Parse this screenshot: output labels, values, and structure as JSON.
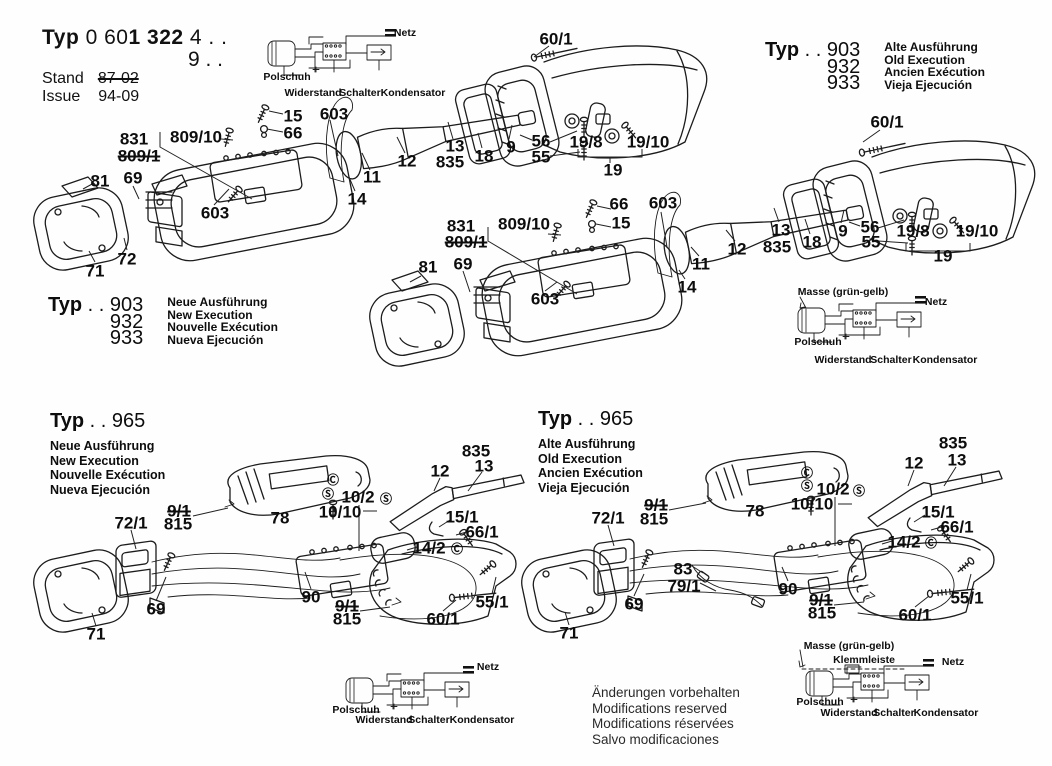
{
  "title": {
    "typ": "Typ",
    "num_a": " 0 60",
    "num_b": "1 322",
    "suffix1": " 4 . .",
    "suffix2": "9 . .",
    "stand_label": "Stand",
    "stand_value": "87-02",
    "issue_label": "Issue",
    "issue_value": "94-09"
  },
  "typ_blocks": [
    {
      "typ": "Typ",
      "dots": ". .",
      "numbers": [
        "903",
        "932",
        "933"
      ],
      "variants": [
        "Alte Ausführung",
        "Old Execution",
        "Ancien Exécution",
        "Vieja Ejecución"
      ]
    },
    {
      "typ": "Typ",
      "dots": ". .",
      "numbers": [
        "903",
        "932",
        "933"
      ],
      "variants": [
        "Neue Ausführung",
        "New Execution",
        "Nouvelle Exécution",
        "Nueva Ejecución"
      ]
    },
    {
      "typ": "Typ",
      "dots": ". .",
      "numbers": [
        "965"
      ],
      "variants": [
        "Neue Ausführung",
        "New Execution",
        "Nouvelle Exécution",
        "Nueva Ejecución"
      ]
    },
    {
      "typ": "Typ",
      "dots": ". .",
      "numbers": [
        "965"
      ],
      "variants": [
        "Alte Ausführung",
        "Old Execution",
        "Ancien Exécution",
        "Vieja Ejecución"
      ]
    }
  ],
  "footer": {
    "lines": [
      "Änderungen vorbehalten",
      "Modifications reserved",
      "Modifications réservées",
      "Salvo modificaciones"
    ]
  },
  "callouts": [
    {
      "t": "60/1",
      "x": 556,
      "y": 39
    },
    {
      "t": "831",
      "x": 134,
      "y": 139
    },
    {
      "t": "809/1",
      "x": 139,
      "y": 156,
      "strike": 1
    },
    {
      "t": "809/10",
      "x": 196,
      "y": 137
    },
    {
      "t": "15",
      "x": 293,
      "y": 116
    },
    {
      "t": "66",
      "x": 293,
      "y": 133
    },
    {
      "t": "603",
      "x": 334,
      "y": 114
    },
    {
      "t": "81",
      "x": 100,
      "y": 181
    },
    {
      "t": "69",
      "x": 133,
      "y": 178
    },
    {
      "t": "603",
      "x": 215,
      "y": 213
    },
    {
      "t": "71",
      "x": 95,
      "y": 271
    },
    {
      "t": "72",
      "x": 127,
      "y": 259
    },
    {
      "t": "12",
      "x": 407,
      "y": 161
    },
    {
      "t": "11",
      "x": 372,
      "y": 177
    },
    {
      "t": "14",
      "x": 357,
      "y": 199
    },
    {
      "t": "13",
      "x": 455,
      "y": 146
    },
    {
      "t": "835",
      "x": 450,
      "y": 162
    },
    {
      "t": "18",
      "x": 484,
      "y": 156
    },
    {
      "t": "9",
      "x": 511,
      "y": 147
    },
    {
      "t": "56",
      "x": 541,
      "y": 141
    },
    {
      "t": "55",
      "x": 541,
      "y": 157
    },
    {
      "t": "19/8",
      "x": 586,
      "y": 142
    },
    {
      "t": "19/10",
      "x": 648,
      "y": 142
    },
    {
      "t": "19",
      "x": 613,
      "y": 170
    },
    {
      "t": "831",
      "x": 461,
      "y": 226
    },
    {
      "t": "809/1",
      "x": 466,
      "y": 242,
      "strike": 1
    },
    {
      "t": "809/10",
      "x": 524,
      "y": 224
    },
    {
      "t": "66",
      "x": 619,
      "y": 204
    },
    {
      "t": "15",
      "x": 621,
      "y": 223
    },
    {
      "t": "603",
      "x": 663,
      "y": 203
    },
    {
      "t": "603",
      "x": 545,
      "y": 299
    },
    {
      "t": "81",
      "x": 428,
      "y": 267
    },
    {
      "t": "69",
      "x": 463,
      "y": 264
    },
    {
      "t": "12",
      "x": 737,
      "y": 249
    },
    {
      "t": "11",
      "x": 701,
      "y": 264
    },
    {
      "t": "14",
      "x": 687,
      "y": 287
    },
    {
      "t": "13",
      "x": 781,
      "y": 230
    },
    {
      "t": "835",
      "x": 777,
      "y": 247
    },
    {
      "t": "18",
      "x": 812,
      "y": 242
    },
    {
      "t": "9",
      "x": 843,
      "y": 231
    },
    {
      "t": "56",
      "x": 870,
      "y": 227
    },
    {
      "t": "55",
      "x": 871,
      "y": 242
    },
    {
      "t": "19/8",
      "x": 913,
      "y": 231
    },
    {
      "t": "19/10",
      "x": 977,
      "y": 231
    },
    {
      "t": "19",
      "x": 943,
      "y": 256
    },
    {
      "t": "60/1",
      "x": 887,
      "y": 122
    },
    {
      "t": "835",
      "x": 476,
      "y": 451
    },
    {
      "t": "13",
      "x": 484,
      "y": 466
    },
    {
      "t": "12",
      "x": 440,
      "y": 471
    },
    {
      "t": "Ⓒ",
      "x": 333,
      "y": 480,
      "fs": 12
    },
    {
      "t": "Ⓢ",
      "x": 328,
      "y": 494,
      "fs": 12
    },
    {
      "t": "10/2",
      "x": 358,
      "y": 497
    },
    {
      "t": "Ⓢ",
      "x": 386,
      "y": 499,
      "fs": 12
    },
    {
      "t": "10/10",
      "x": 340,
      "y": 512
    },
    {
      "t": "78",
      "x": 280,
      "y": 518
    },
    {
      "t": "15/1",
      "x": 462,
      "y": 517
    },
    {
      "t": "66/1",
      "x": 482,
      "y": 532
    },
    {
      "t": "14/2",
      "x": 429,
      "y": 548
    },
    {
      "t": "Ⓒ",
      "x": 457,
      "y": 549,
      "fs": 12
    },
    {
      "t": "72/1",
      "x": 131,
      "y": 523
    },
    {
      "t": "9/1",
      "x": 179,
      "y": 511,
      "strike": 1
    },
    {
      "t": "815",
      "x": 178,
      "y": 524
    },
    {
      "t": "69",
      "x": 156,
      "y": 609
    },
    {
      "t": "90",
      "x": 311,
      "y": 597
    },
    {
      "t": "9/1",
      "x": 347,
      "y": 606,
      "strike": 1
    },
    {
      "t": "815",
      "x": 347,
      "y": 619
    },
    {
      "t": "60/1",
      "x": 443,
      "y": 619
    },
    {
      "t": "55/1",
      "x": 492,
      "y": 602
    },
    {
      "t": "71",
      "x": 96,
      "y": 634
    },
    {
      "t": "835",
      "x": 953,
      "y": 443
    },
    {
      "t": "13",
      "x": 957,
      "y": 460
    },
    {
      "t": "12",
      "x": 914,
      "y": 463
    },
    {
      "t": "Ⓒ",
      "x": 807,
      "y": 473,
      "fs": 12
    },
    {
      "t": "Ⓢ",
      "x": 807,
      "y": 486,
      "fs": 12
    },
    {
      "t": "10/2",
      "x": 833,
      "y": 489
    },
    {
      "t": "Ⓢ",
      "x": 859,
      "y": 491,
      "fs": 12
    },
    {
      "t": "10/10",
      "x": 812,
      "y": 504
    },
    {
      "t": "78",
      "x": 755,
      "y": 511
    },
    {
      "t": "15/1",
      "x": 938,
      "y": 512
    },
    {
      "t": "66/1",
      "x": 957,
      "y": 527
    },
    {
      "t": "14/2",
      "x": 904,
      "y": 542
    },
    {
      "t": "Ⓒ",
      "x": 931,
      "y": 543,
      "fs": 12
    },
    {
      "t": "72/1",
      "x": 608,
      "y": 518
    },
    {
      "t": "9/1",
      "x": 656,
      "y": 505,
      "strike": 1
    },
    {
      "t": "815",
      "x": 654,
      "y": 519
    },
    {
      "t": "83",
      "x": 683,
      "y": 569
    },
    {
      "t": "79/1",
      "x": 684,
      "y": 586
    },
    {
      "t": "69",
      "x": 634,
      "y": 604
    },
    {
      "t": "90",
      "x": 788,
      "y": 589
    },
    {
      "t": "9/1",
      "x": 821,
      "y": 600,
      "strike": 1
    },
    {
      "t": "815",
      "x": 822,
      "y": 613
    },
    {
      "t": "60/1",
      "x": 915,
      "y": 615
    },
    {
      "t": "55/1",
      "x": 967,
      "y": 598
    },
    {
      "t": "71",
      "x": 569,
      "y": 633
    }
  ],
  "wiring_diagrams": [
    {
      "id": "top",
      "labels": [
        {
          "t": "Netz",
          "x": 405,
          "y": 33
        },
        {
          "t": "Polschuh",
          "x": 287,
          "y": 77
        },
        {
          "t": "Widerstand",
          "x": 313,
          "y": 93
        },
        {
          "t": "Schalter",
          "x": 360,
          "y": 93
        },
        {
          "t": "Kondensator",
          "x": 413,
          "y": 93
        }
      ]
    },
    {
      "id": "right-middle",
      "labels": [
        {
          "t": "Masse (grün-gelb)",
          "x": 843,
          "y": 292
        },
        {
          "t": "Netz",
          "x": 936,
          "y": 302
        },
        {
          "t": "Polschuh",
          "x": 818,
          "y": 342
        },
        {
          "t": "Widerstand",
          "x": 843,
          "y": 360
        },
        {
          "t": "Schalter",
          "x": 891,
          "y": 360
        },
        {
          "t": "Kondensator",
          "x": 945,
          "y": 360
        }
      ]
    },
    {
      "id": "bottom-left",
      "labels": [
        {
          "t": "Netz",
          "x": 488,
          "y": 667
        },
        {
          "t": "Polschuh",
          "x": 356,
          "y": 710
        },
        {
          "t": "Widerstand",
          "x": 384,
          "y": 720
        },
        {
          "t": "Schalter",
          "x": 429,
          "y": 720
        },
        {
          "t": "Kondensator",
          "x": 482,
          "y": 720
        }
      ]
    },
    {
      "id": "bottom-right",
      "labels": [
        {
          "t": "Masse (grün-gelb)",
          "x": 849,
          "y": 646
        },
        {
          "t": "Klemmleiste",
          "x": 864,
          "y": 660
        },
        {
          "t": "Netz",
          "x": 953,
          "y": 662
        },
        {
          "t": "Polschuh",
          "x": 820,
          "y": 702
        },
        {
          "t": "Widerstand",
          "x": 849,
          "y": 713
        },
        {
          "t": "Schalter",
          "x": 894,
          "y": 713
        },
        {
          "t": "Kondensator",
          "x": 946,
          "y": 713
        }
      ]
    }
  ]
}
